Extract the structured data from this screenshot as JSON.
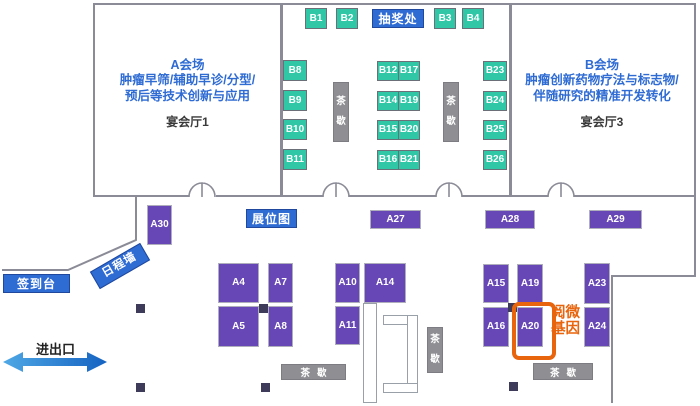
{
  "rooms": {
    "a": {
      "title": "A会场",
      "line1": "肿瘤早筛/辅助早诊/分型/",
      "line2": "预后等技术创新与应用",
      "hall": "宴会厅1"
    },
    "b": {
      "title": "B会场",
      "line1": "肿瘤创新药物疗法与标志物/",
      "line2": "伴随研究的精准开发转化",
      "hall": "宴会厅3"
    }
  },
  "labels": {
    "lottery": "抽奖处",
    "floor_map": "展位图",
    "signin_desk": "签到台",
    "schedule_wall": "日程墙",
    "entrance_exit": "进出口",
    "tea_break": "茶歇",
    "highlight_exhibitor": "阅微\n基因"
  },
  "booths": {
    "b_top": [
      "B1",
      "B2",
      "B3",
      "B4"
    ],
    "b_left": [
      "B8",
      "B9",
      "B10",
      "B11"
    ],
    "b_mid_left": [
      "B12",
      "B14",
      "B15",
      "B16"
    ],
    "b_mid_right": [
      "B17",
      "B19",
      "B20",
      "B21"
    ],
    "b_right": [
      "B23",
      "B24",
      "B25",
      "B26"
    ],
    "a_band": [
      "A30",
      "A27",
      "A28",
      "A29"
    ],
    "a_island1": [
      "A4",
      "A7",
      "A5",
      "A8"
    ],
    "a_island2": [
      "A10",
      "A14",
      "A11"
    ],
    "a_island3": [
      "A15",
      "A19",
      "A16",
      "A20"
    ],
    "a_island4": [
      "A23",
      "A24"
    ]
  },
  "colors": {
    "booth_green": "#2FC7A6",
    "booth_purple": "#6747B5",
    "sign_blue": "#2E6BD3",
    "tea_gray": "#8F8F93",
    "highlight_orange": "#E8650D",
    "wall_gray": "#8b8b97",
    "pillar_dark": "#3E3A59"
  }
}
